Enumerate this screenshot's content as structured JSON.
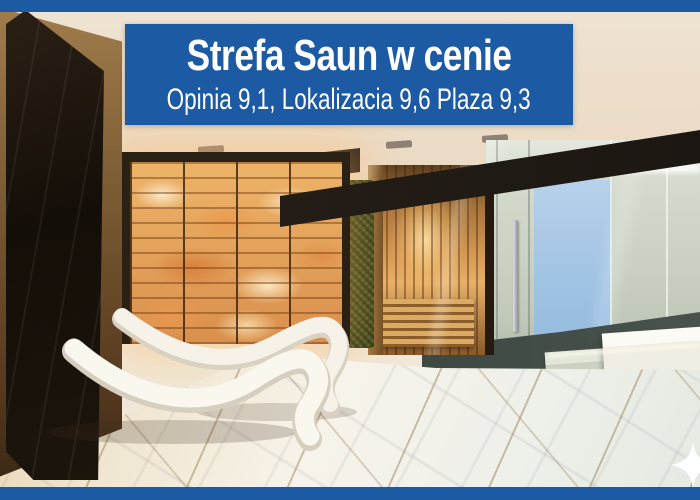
{
  "banner": {
    "title": "Strefa Saun w cenie",
    "subtitle": "Opinia 9,1, Lokalizacia 9,6 Plaza 9,3"
  },
  "colors": {
    "accent": "#1c5ba4",
    "banner_text": "#ffffff",
    "salt_glow": "#f3b872",
    "moss": "#3c491f",
    "marble": "#f2ead8",
    "lounger": "#f6f2e8"
  },
  "icons": [
    {
      "name": "sparkle-icon",
      "glyph": "✦"
    }
  ],
  "scene": {
    "subject": "spa sauna zone with backlit salt wall, wooden sauna cabin, glass steam room and wave loungers"
  }
}
